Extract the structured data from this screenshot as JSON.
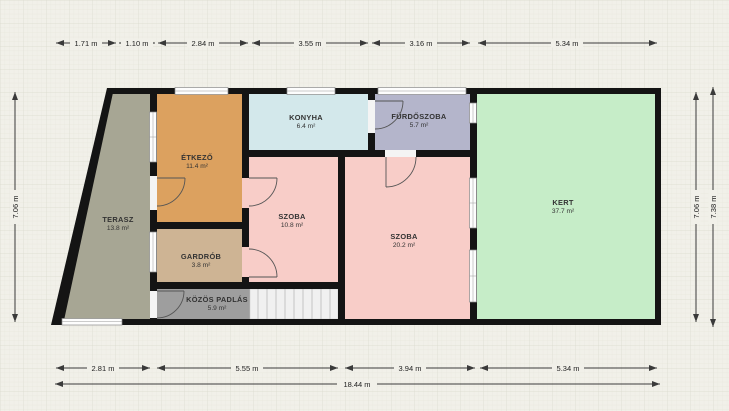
{
  "plan": {
    "title": "floor-plan",
    "rooms": [
      {
        "name": "TERASZ",
        "area": "13.8 m²"
      },
      {
        "name": "ÉTKEZŐ",
        "area": "11.4 m²"
      },
      {
        "name": "KONYHA",
        "area": "6.4 m²"
      },
      {
        "name": "FÜRDŐSZOBA",
        "area": "5.7 m²"
      },
      {
        "name": "SZOBA",
        "area": "10.8 m²"
      },
      {
        "name": "SZOBA",
        "area": "20.2 m²"
      },
      {
        "name": "KERT",
        "area": "37.7 m²"
      },
      {
        "name": "GARDRÓB",
        "area": "3.8 m²"
      },
      {
        "name": "KÖZÖS PADLÁS",
        "area": "5.9 m²"
      }
    ],
    "dimensions": {
      "top": [
        "1.71 m",
        "1.10 m",
        "2.84 m",
        "3.55 m",
        "3.16 m",
        "5.34 m"
      ],
      "bottom": [
        "2.81 m",
        "5.55 m",
        "3.94 m",
        "5.34 m"
      ],
      "total": "18.44 m",
      "left": "7.06 m",
      "right_inner": "7.06 m",
      "right_outer": "7.38 m"
    },
    "colors": {
      "background": "#f1f0e9",
      "wall": "#141414",
      "terasz": "#a7a694",
      "etkezo": "#dca15f",
      "konyha": "#d3e8eb",
      "furdoszoba": "#b4b5cb",
      "szoba": "#f8cdc8",
      "kert": "#c6edc8",
      "gardrob": "#ceb494",
      "padlas": "#9e9e9e",
      "stairs": "#f0f0f0",
      "window": "#fdfdfd"
    }
  }
}
